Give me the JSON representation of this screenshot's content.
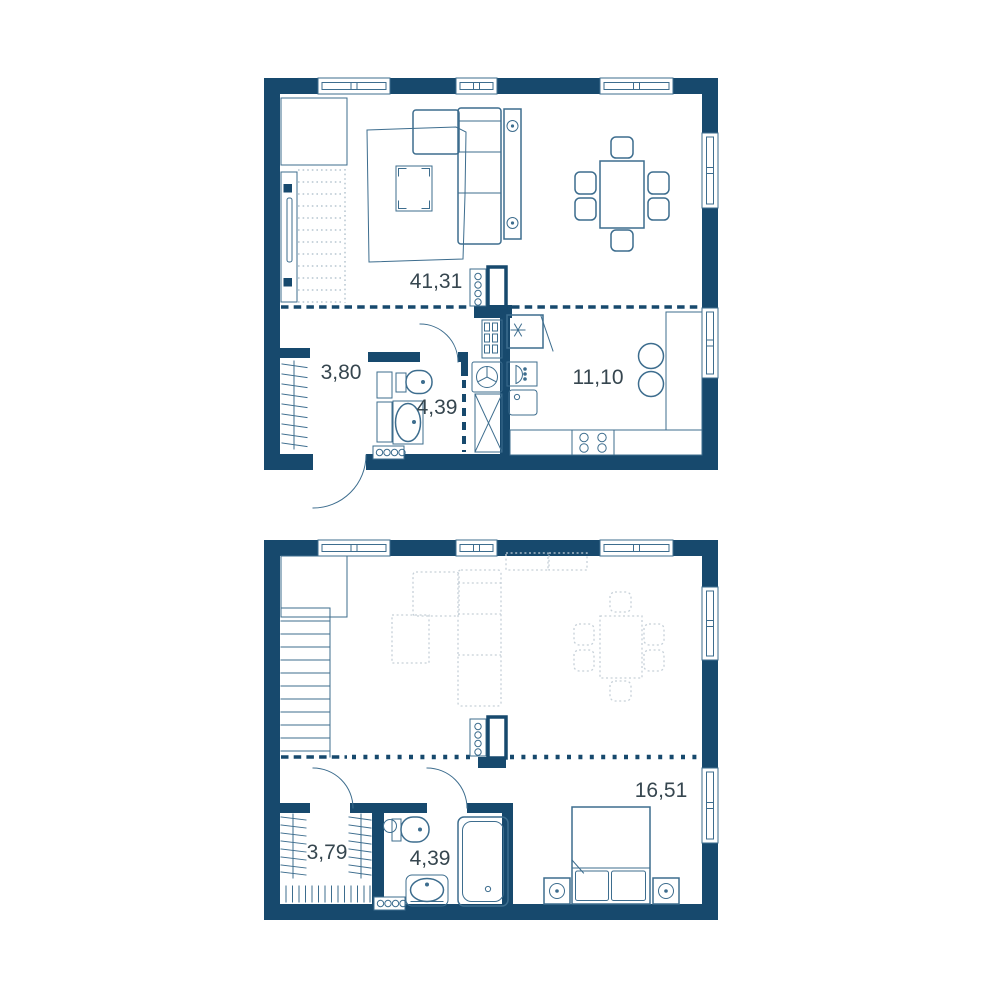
{
  "title": "Two-level apartment floor plan",
  "colors": {
    "wall": "#17496d",
    "furniture_line": "#3d6d8e",
    "label_text": "#36464f",
    "ghost_line": "#c6d0d8",
    "stair_dotted": "#93aab9",
    "background": "#ffffff"
  },
  "floor1": {
    "rooms": [
      {
        "name": "living-dining-room",
        "area": "41,31"
      },
      {
        "name": "hallway",
        "area": "3,80"
      },
      {
        "name": "bathroom",
        "area": "4,39"
      },
      {
        "name": "kitchen",
        "area": "11,10"
      }
    ]
  },
  "floor2": {
    "rooms": [
      {
        "name": "bedroom-hall",
        "area": "16,51"
      },
      {
        "name": "wardrobe",
        "area": "3,79"
      },
      {
        "name": "bathroom",
        "area": "4,39"
      }
    ]
  }
}
